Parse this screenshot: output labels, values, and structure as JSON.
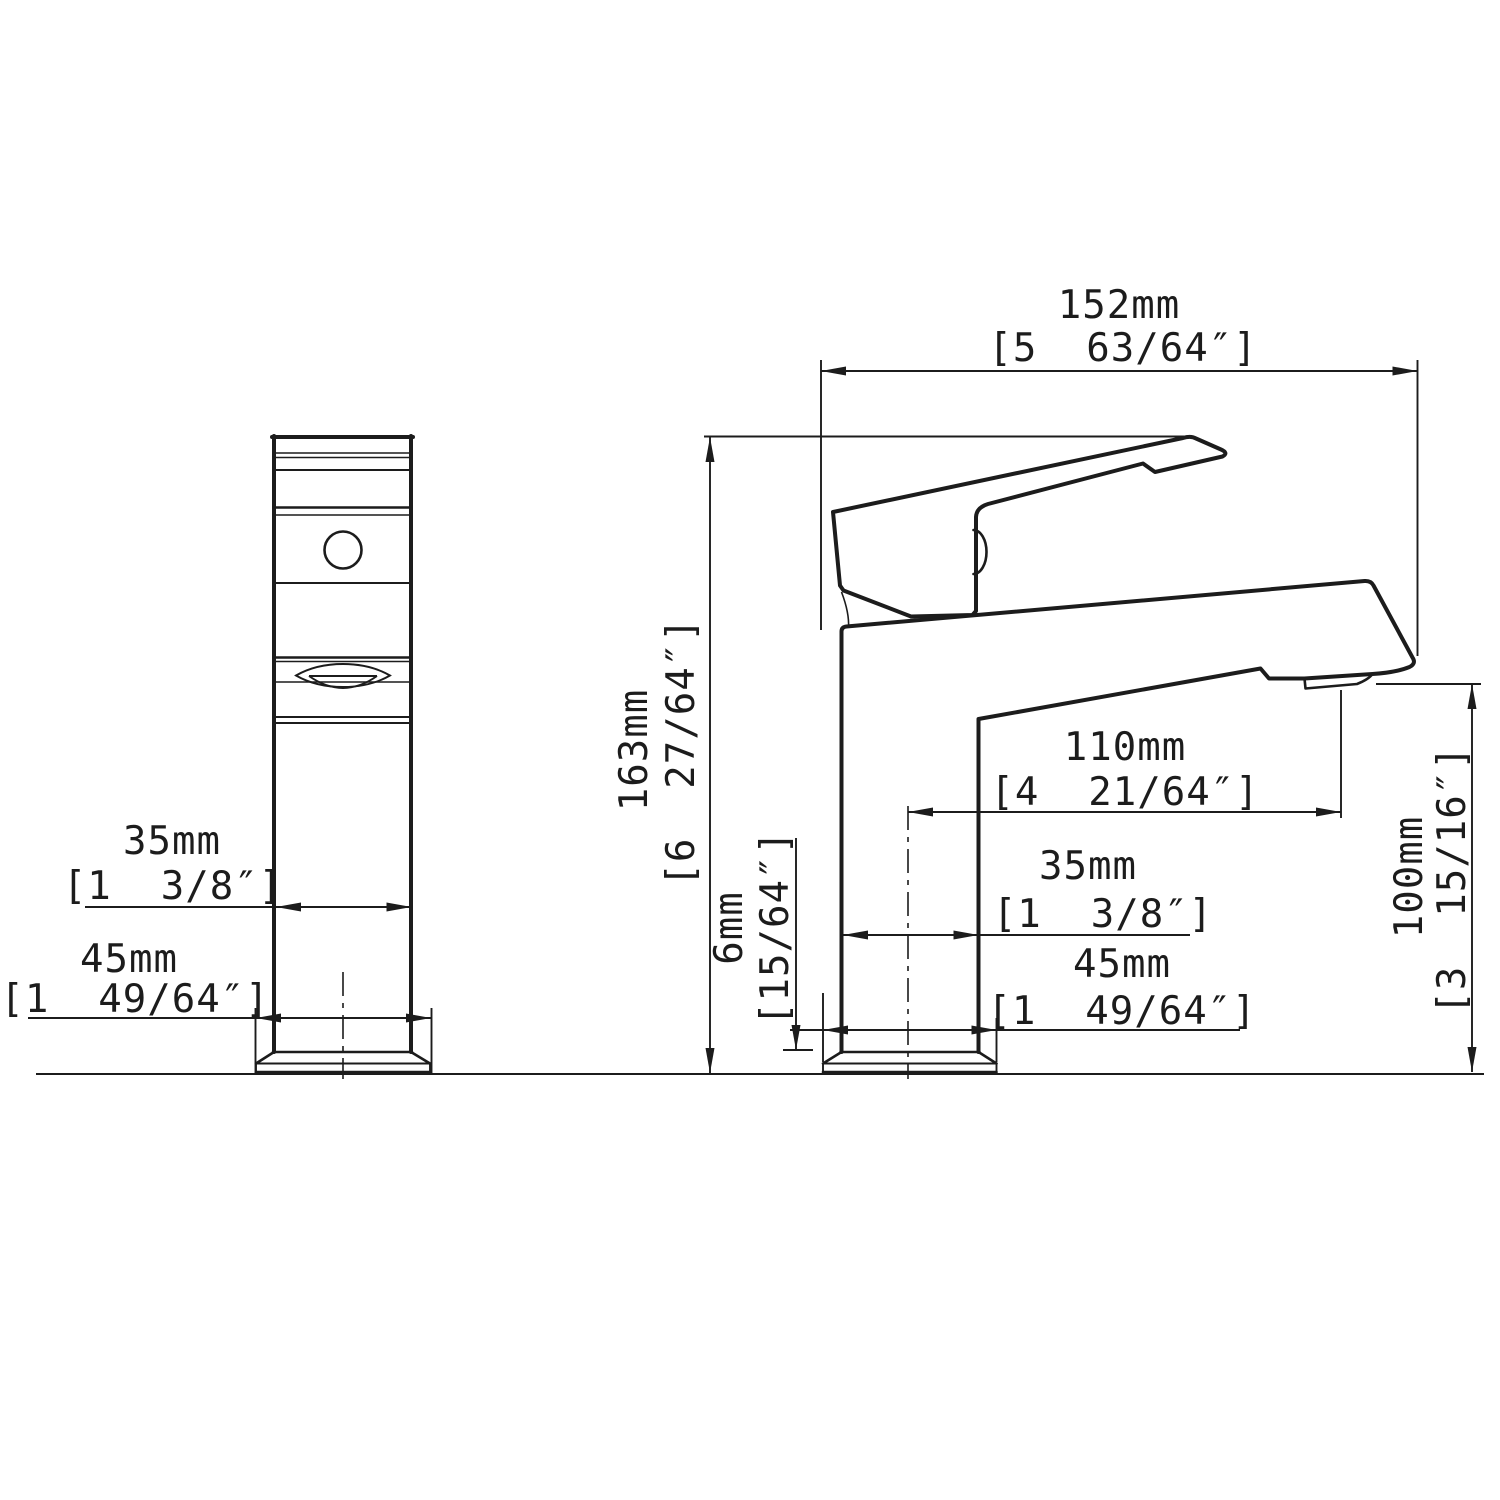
{
  "drawing": {
    "dimensions": {
      "front_body_width": {
        "mm": "35mm",
        "inch": "[1  3/8″]"
      },
      "front_base_width": {
        "mm": "45mm",
        "inch": "[1  49/64″]"
      },
      "overall_length": {
        "mm": "152mm",
        "inch": "[5  63/64″]"
      },
      "overall_height": {
        "mm": "163mm",
        "inch": "[6  27/64″]"
      },
      "spout_reach": {
        "mm": "110mm",
        "inch": "[4  21/64″]"
      },
      "side_body_width": {
        "mm": "35mm",
        "inch": "[1  3/8″]"
      },
      "side_base_width": {
        "mm": "45mm",
        "inch": "[1  49/64″]"
      },
      "spout_height": {
        "mm": "100mm",
        "inch": "[3  15/16″]"
      },
      "base_plate_height": {
        "mm": "6mm",
        "inch": "[15/64″]"
      }
    },
    "colors": {
      "line": "#1c1c1c",
      "background": "#ffffff"
    }
  }
}
